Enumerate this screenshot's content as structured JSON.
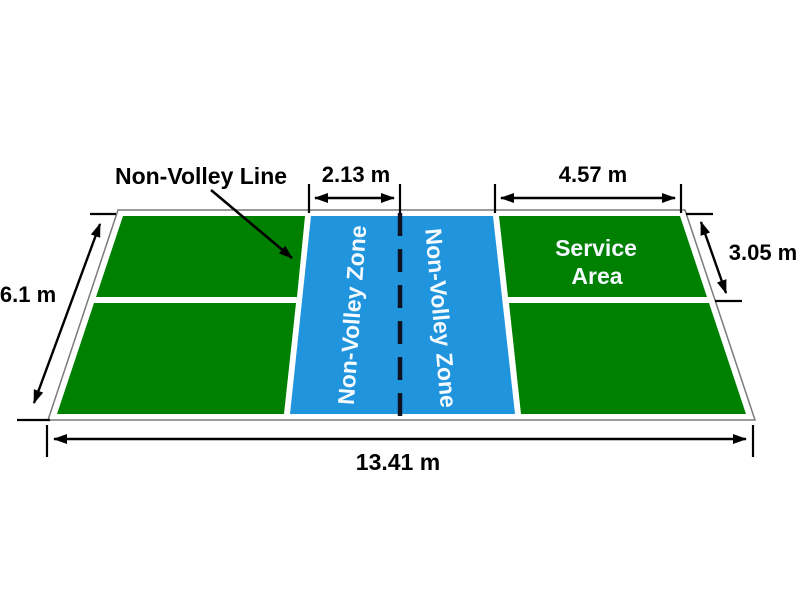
{
  "diagram": {
    "background": "#ffffff",
    "colors": {
      "court_surface_green": "#008000",
      "non_volley_zone_blue": "#2094dc",
      "court_line_white": "#ffffff",
      "court_outline_gray": "#7a7a7a",
      "net_line_dark": "#0c1220",
      "annotation_black": "#000000",
      "zone_text_white": "#f4faff"
    },
    "labels": {
      "non_volley_line": "Non-Volley Line",
      "non_volley_zone_left": "Non-Volley Zone",
      "non_volley_zone_right": "Non-Volley Zone",
      "service_area": {
        "line1": "Service",
        "line2": "Area"
      }
    },
    "dimensions": {
      "non_volley_zone_depth": "2.13 m",
      "service_area_length": "4.57 m",
      "service_area_width": "3.05 m",
      "court_width": "6.1 m",
      "court_length": "13.41 m"
    }
  }
}
